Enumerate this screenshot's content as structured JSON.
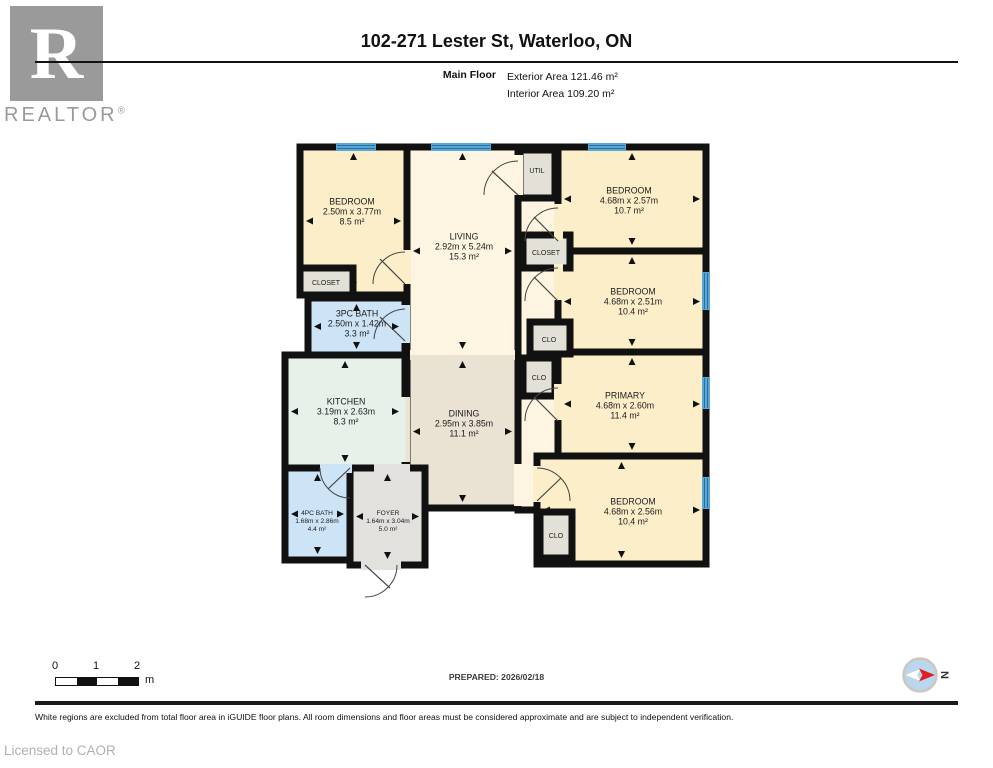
{
  "header": {
    "logo_text": "REALTOR",
    "logo_reg": "®",
    "title": "102-271 Lester St, Waterloo, ON",
    "floor_label": "Main Floor",
    "exterior_area": "Exterior Area 121.46 m²",
    "interior_area": "Interior Area 109.20 m²"
  },
  "floorplan": {
    "colors": {
      "wall": "#111111",
      "window": "#57a7d8",
      "window_line": "#2e6f99",
      "bedroom": "#fbeec9",
      "living": "#fdf5e1",
      "dining": "#eae2d3",
      "kitchen": "#e7f1e9",
      "bath": "#cde4f7",
      "closet": "#e3e0d8",
      "foyer": "#e2e1de"
    },
    "rooms": [
      {
        "id": "hallway",
        "rect": [
          518,
          147,
          40,
          363
        ],
        "fill": "living"
      },
      {
        "id": "living",
        "rect": [
          407,
          147,
          111,
          208
        ],
        "fill": "living",
        "label": [
          464,
          247
        ],
        "lines": [
          "LIVING",
          "2.92m x 5.24m",
          "15.3 m²"
        ]
      },
      {
        "id": "dining",
        "rect": [
          407,
          355,
          111,
          153
        ],
        "fill": "dining",
        "label": [
          464,
          424
        ],
        "lines": [
          "DINING",
          "2.95m x 3.85m",
          "11.1 m²"
        ]
      },
      {
        "id": "kitchen",
        "rect": [
          285,
          355,
          120,
          113
        ],
        "fill": "kitchen",
        "label": [
          346,
          412
        ],
        "lines": [
          "KITCHEN",
          "3.19m x 2.63m",
          "8.3 m²"
        ]
      },
      {
        "id": "bedroom-1",
        "rect": [
          300,
          147,
          107,
          148
        ],
        "fill": "bedroom",
        "label": [
          352,
          212
        ],
        "lines": [
          "BEDROOM",
          "2.50m x 3.77m",
          "8.5 m²"
        ]
      },
      {
        "id": "bath-3pc",
        "rect": [
          308,
          298,
          97,
          57
        ],
        "fill": "bath",
        "label": [
          357,
          324
        ],
        "lines": [
          "3PC BATH",
          "2.50m x 1.42m",
          "3.3 m²"
        ]
      },
      {
        "id": "bath-4pc",
        "rect": [
          285,
          468,
          65,
          92
        ],
        "fill": "bath",
        "label": [
          317,
          521
        ],
        "lines": [
          "4PC BATH",
          "1.68m x 2.86m",
          "4.4 m²"
        ],
        "fs": 6.6,
        "lh": 8
      },
      {
        "id": "foyer",
        "rect": [
          350,
          468,
          75,
          97
        ],
        "fill": "foyer",
        "label": [
          388,
          521
        ],
        "lines": [
          "FOYER",
          "1.64m x 3.04m",
          "5.0 m²"
        ],
        "fs": 6.6,
        "lh": 8
      },
      {
        "id": "bedroom-2",
        "rect": [
          558,
          147,
          148,
          104
        ],
        "fill": "bedroom",
        "label": [
          629,
          201
        ],
        "lines": [
          "BEDROOM",
          "4.68m x 2.57m",
          "10.7 m²"
        ]
      },
      {
        "id": "bedroom-3",
        "rect": [
          558,
          251,
          148,
          101
        ],
        "fill": "bedroom",
        "label": [
          633,
          302
        ],
        "lines": [
          "BEDROOM",
          "4.68m x 2.51m",
          "10.4 m²"
        ]
      },
      {
        "id": "primary",
        "rect": [
          558,
          352,
          148,
          104
        ],
        "fill": "bedroom",
        "label": [
          625,
          406
        ],
        "lines": [
          "PRIMARY",
          "4.68m x 2.60m",
          "11.4 m²"
        ]
      },
      {
        "id": "bedroom-4",
        "rect": [
          537,
          456,
          169,
          108
        ],
        "fill": "bedroom",
        "label": [
          633,
          512
        ],
        "lines": [
          "BEDROOM",
          "4.68m x 2.56m",
          "10.4 m²"
        ]
      },
      {
        "id": "closet-1",
        "rect": [
          300,
          268,
          53,
          27
        ],
        "fill": "closet",
        "label": [
          326,
          283
        ],
        "lines": [
          "CLOSET"
        ],
        "fs": 7,
        "lh": 8
      },
      {
        "id": "closet-2",
        "rect": [
          523,
          235,
          47,
          33
        ],
        "fill": "closet",
        "label": [
          546,
          253
        ],
        "lines": [
          "CLOSET"
        ],
        "fs": 7,
        "lh": 8
      },
      {
        "id": "clo-1",
        "rect": [
          530,
          322,
          40,
          32
        ],
        "fill": "closet",
        "label": [
          549,
          340
        ],
        "lines": [
          "CLO"
        ],
        "fs": 7,
        "lh": 8
      },
      {
        "id": "clo-2",
        "rect": [
          523,
          358,
          32,
          38
        ],
        "fill": "closet",
        "label": [
          539,
          378
        ],
        "lines": [
          "CLO"
        ],
        "fs": 7,
        "lh": 8
      },
      {
        "id": "clo-3",
        "rect": [
          540,
          512,
          32,
          46
        ],
        "fill": "closet",
        "label": [
          556,
          536
        ],
        "lines": [
          "CLO"
        ],
        "fs": 7,
        "lh": 8
      },
      {
        "id": "util",
        "rect": [
          520,
          150,
          35,
          48
        ],
        "fill": "closet",
        "label": [
          537,
          171
        ],
        "lines": [
          "UTIL"
        ],
        "fs": 7,
        "lh": 8
      }
    ],
    "doors": [
      {
        "g": [
          402,
          250,
          9,
          34
        ],
        "f": "bedroom",
        "a": "M405 252 A32 32 0 0 0 373 284",
        "l": [
          405,
          284,
          380,
          259
        ]
      },
      {
        "g": [
          514,
          155,
          9,
          40
        ],
        "f": "living",
        "a": "M518 161 A34 34 0 0 0 484 195",
        "l": [
          518,
          195,
          492,
          171
        ]
      },
      {
        "g": [
          554,
          204,
          9,
          36
        ],
        "f": "bedroom",
        "a": "M558 208 A33 33 0 0 0 525 241",
        "l": [
          558,
          241,
          534,
          217
        ]
      },
      {
        "g": [
          554,
          264,
          9,
          36
        ],
        "f": "bedroom",
        "a": "M558 268 A33 33 0 0 0 525 301",
        "l": [
          558,
          301,
          534,
          277
        ]
      },
      {
        "g": [
          554,
          384,
          9,
          36
        ],
        "f": "bedroom",
        "a": "M558 388 A33 33 0 0 0 525 421",
        "l": [
          558,
          421,
          534,
          397
        ]
      },
      {
        "g": [
          533,
          466,
          9,
          36
        ],
        "f": "bedroom",
        "a": "M537 468 A33 33 0 0 1 570 501",
        "l": [
          537,
          501,
          561,
          478
        ]
      },
      {
        "g": [
          401,
          305,
          9,
          38
        ],
        "f": "bath",
        "a": "M405 309 A32 32 0 0 0 374 339",
        "l": [
          405,
          341,
          380,
          317
        ]
      },
      {
        "g": [
          320,
          464,
          32,
          9
        ],
        "f": "bath",
        "a": "M320 468 A30 30 0 0 0 350 498",
        "l": [
          350,
          468,
          328,
          489
        ]
      },
      {
        "g": [
          361,
          561,
          40,
          9
        ],
        "f": "foyer",
        "a": "M397 565 A32 32 0 0 1 365 597",
        "l": [
          365,
          565,
          390,
          588
        ]
      },
      {
        "g": [
          514,
          464,
          9,
          42
        ],
        "f": "living"
      },
      {
        "g": [
          410,
          350,
          105,
          5
        ],
        "f": "living"
      },
      {
        "g": [
          410,
          355,
          105,
          5
        ],
        "f": "dining"
      },
      {
        "g": [
          401,
          397,
          4.5,
          65
        ],
        "f": "kitchen"
      },
      {
        "g": [
          405.5,
          397,
          4.5,
          65
        ],
        "f": "dining"
      },
      {
        "g": [
          374,
          464,
          36,
          9
        ],
        "f": "foyer"
      }
    ],
    "windows": [
      {
        "r": [
          336,
          143,
          40,
          8
        ],
        "o": "h"
      },
      {
        "r": [
          431,
          143,
          60,
          8
        ],
        "o": "h"
      },
      {
        "r": [
          588,
          143,
          38,
          8
        ],
        "o": "h"
      },
      {
        "r": [
          702,
          272,
          8,
          38
        ],
        "o": "v"
      },
      {
        "r": [
          702,
          377,
          8,
          32
        ],
        "o": "v"
      },
      {
        "r": [
          702,
          477,
          8,
          32
        ],
        "o": "v"
      }
    ]
  },
  "footer": {
    "scale": {
      "l0": "0",
      "l1": "1",
      "l2": "2",
      "unit": "m"
    },
    "prepared": "PREPARED: 2026/02/18",
    "compass_label": "N",
    "disclaimer": "White regions are excluded from total floor area in iGUIDE floor plans. All room dimensions and floor areas must be considered approximate and are subject to independent verification.",
    "licensed": "Licensed to CAOR"
  }
}
